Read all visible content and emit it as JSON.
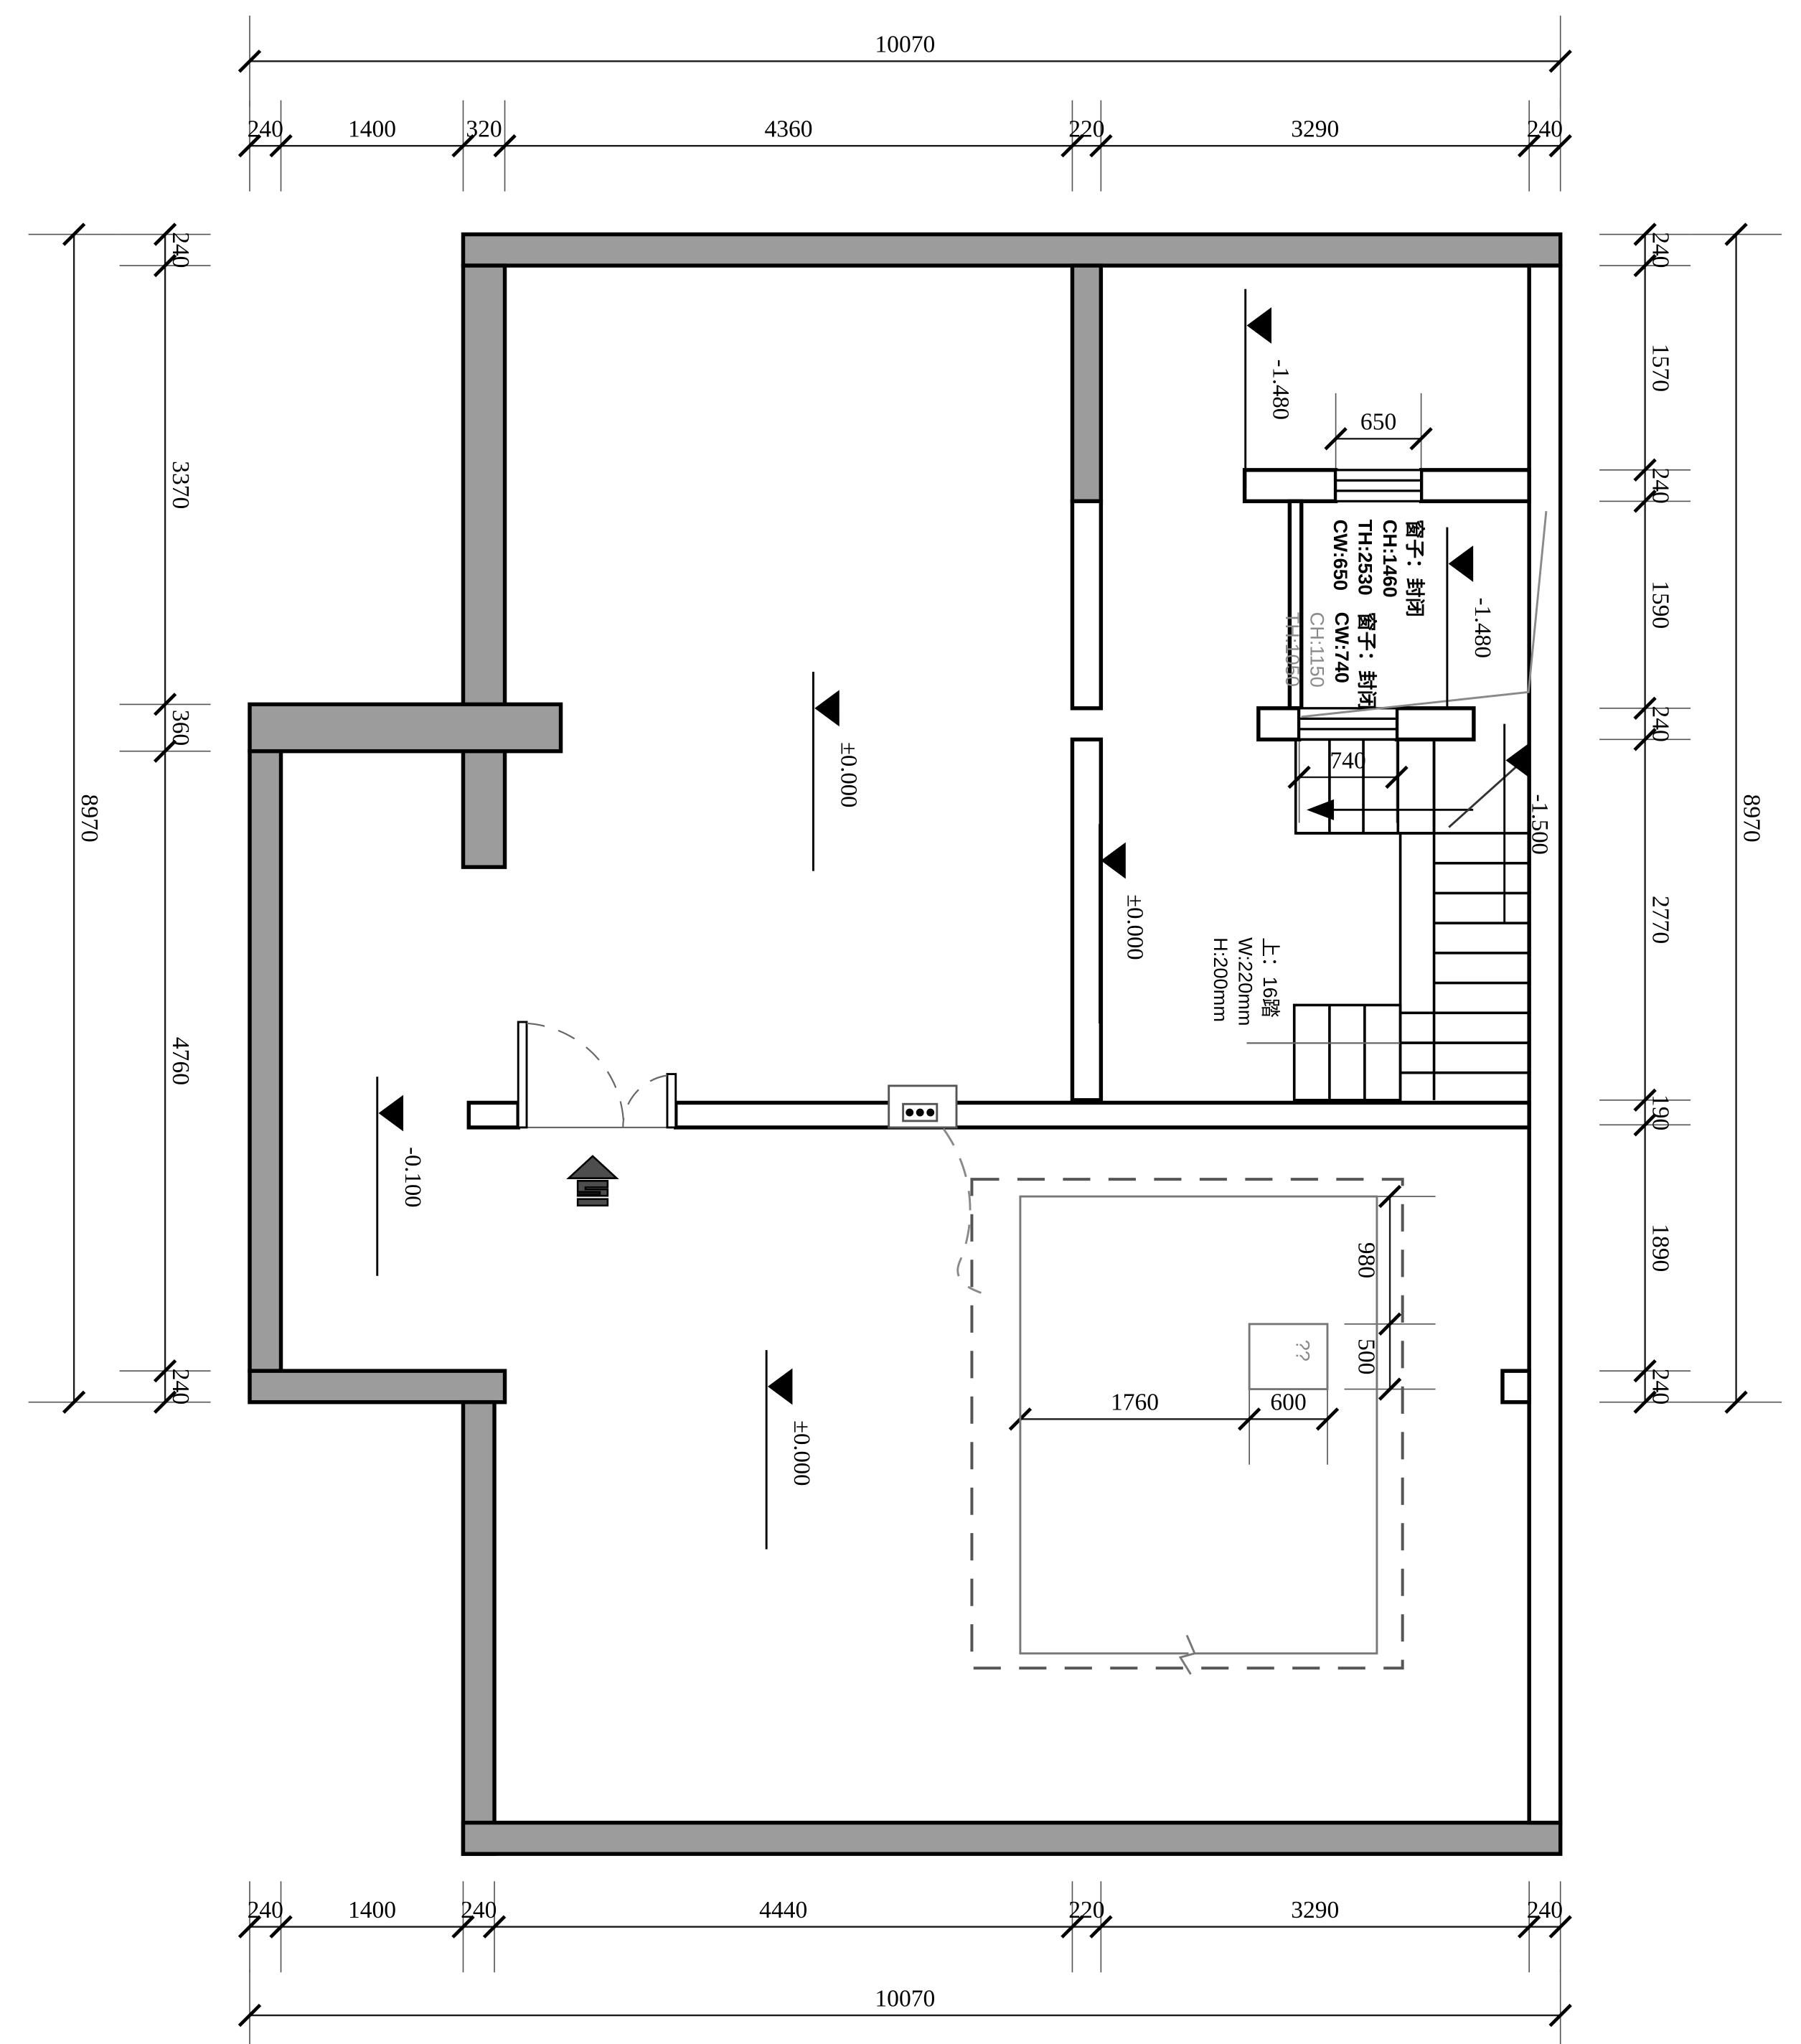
{
  "drawing": {
    "type": "architectural-floor-plan",
    "units": "mm",
    "overall_width": "10070",
    "overall_height": "8970"
  },
  "dim_chains": {
    "top_overall": [
      "10070"
    ],
    "top": [
      "240",
      "1400",
      "320",
      "4360",
      "220",
      "3290",
      "240"
    ],
    "bottom": [
      "240",
      "1400",
      "240",
      "4440",
      "220",
      "3290",
      "240"
    ],
    "bottom_overall": [
      "10070"
    ],
    "left": [
      "240",
      "3370",
      "360",
      "4760",
      "240"
    ],
    "left_overall": [
      "8970"
    ],
    "right": [
      "240",
      "1570",
      "240",
      "1590",
      "240",
      "2770",
      "190",
      "1890",
      "240"
    ],
    "right_overall": [
      "8970"
    ],
    "window1_width": [
      "650"
    ],
    "window2_width": [
      "740"
    ],
    "island_v": [
      "980",
      "500"
    ],
    "island_h": [
      "1760",
      "600"
    ]
  },
  "elevation_markers": {
    "m1": "-1.480",
    "m2": "-1.480",
    "m3": "-1.500",
    "m4": "±0.000",
    "m5": "±0.000",
    "m6": "-0.100",
    "m7": "±0.000"
  },
  "window_labels": {
    "w1": [
      "窗子：封闭",
      "CH:1460",
      "TH:2530",
      "CW:650"
    ],
    "w2": [
      "窗子：封闭",
      "CW:740",
      "CH:1150",
      "TH:1050"
    ]
  },
  "stair_label": [
    "上：16踏",
    "W:220mm",
    "H:200mm"
  ],
  "island_label": "??",
  "colors": {
    "wall_gray": "#9c9c9c",
    "line_black": "#000000",
    "annotation_gray": "#8a8a8a",
    "arrow_dark": "#4d4d4d"
  }
}
